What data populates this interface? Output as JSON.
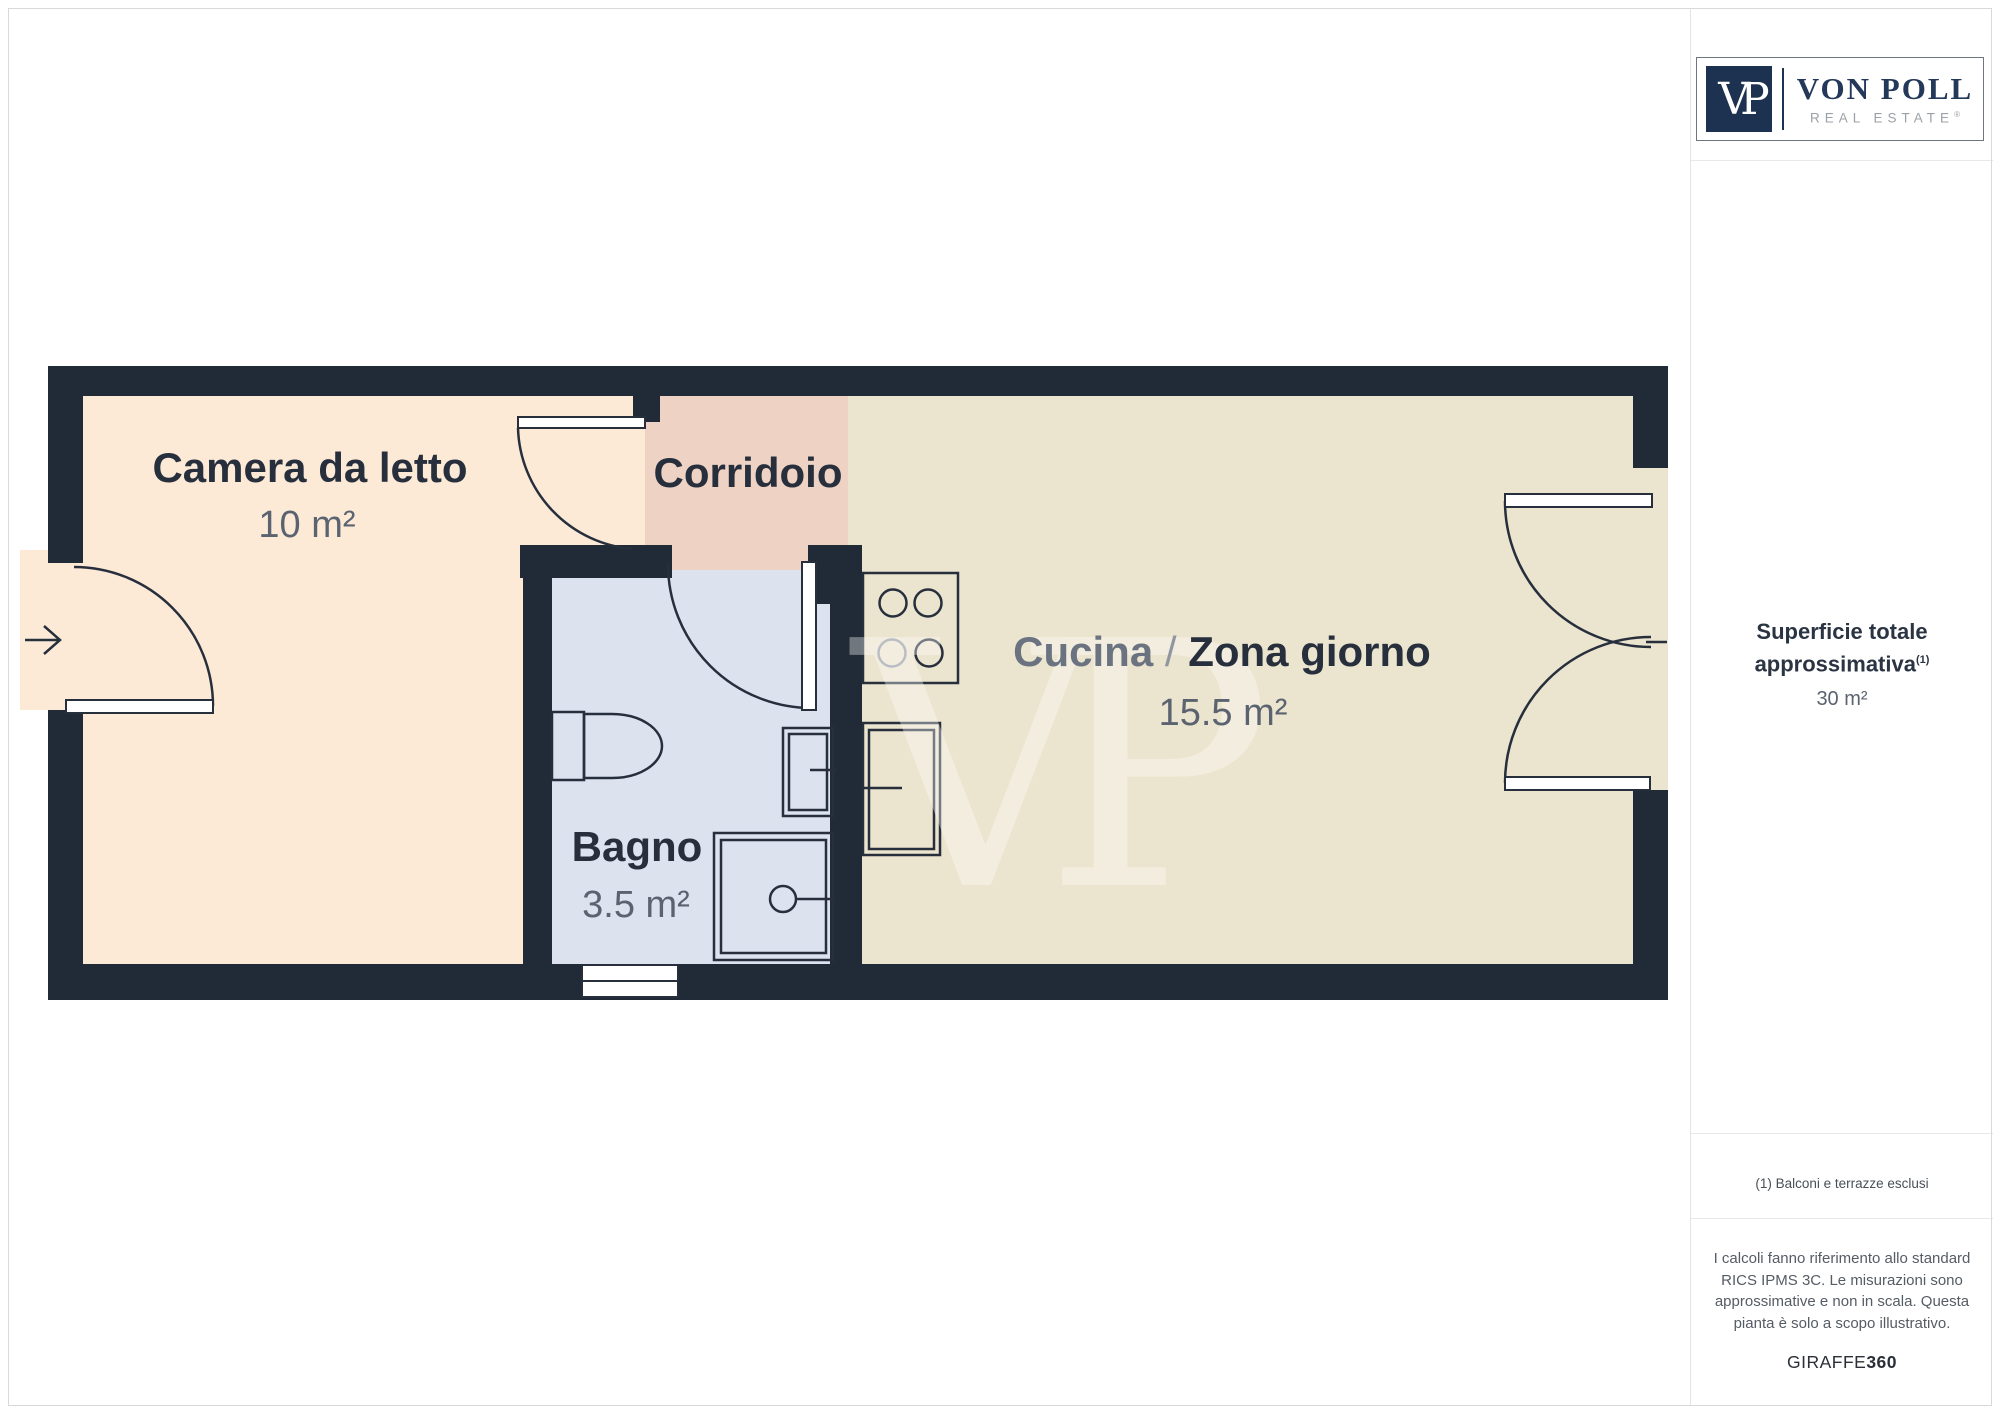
{
  "floor_plan": {
    "watermark": "VP",
    "rooms": [
      {
        "id": "bedroom",
        "name": "Camera da letto",
        "area": "10 m²",
        "color": "#fcead7"
      },
      {
        "id": "corridor",
        "name": "Corridoio",
        "color": "#eed3c5"
      },
      {
        "id": "kitchen",
        "name_primary": "Cucina",
        "separator": " / ",
        "name_secondary": "Zona giorno",
        "area": "15.5 m²",
        "color": "#ebe4ce"
      },
      {
        "id": "bathroom",
        "name": "Bagno",
        "area": "3.5 m²",
        "color": "#dce2ee"
      }
    ],
    "colors": {
      "wall": "#212a37",
      "line": "#272f3d",
      "room_title": "#272f3d",
      "room_area": "#5b6370",
      "watermark": "#ffffff",
      "fixture_faded": "#949aa3"
    }
  },
  "sidebar": {
    "logo": {
      "monogram": "VP",
      "brand": "VON POLL",
      "tagline": "REAL ESTATE",
      "registered": "®",
      "navy": "#1d3150"
    },
    "total_area": {
      "label_line1": "Superficie totale",
      "label_line2": "approssimativa",
      "footnote_marker": "(1)",
      "value": "30 m²"
    },
    "footnote": "(1) Balconi e terrazze esclusi",
    "disclaimer_lines": [
      "I calcoli fanno riferimento allo standard",
      "RICS IPMS 3C. Le misurazioni sono",
      "approssimative e non in scala. Questa",
      "pianta è solo a scopo illustrativo."
    ],
    "brand_footer": {
      "regular": "GIRAFFE",
      "bold": "360"
    }
  }
}
